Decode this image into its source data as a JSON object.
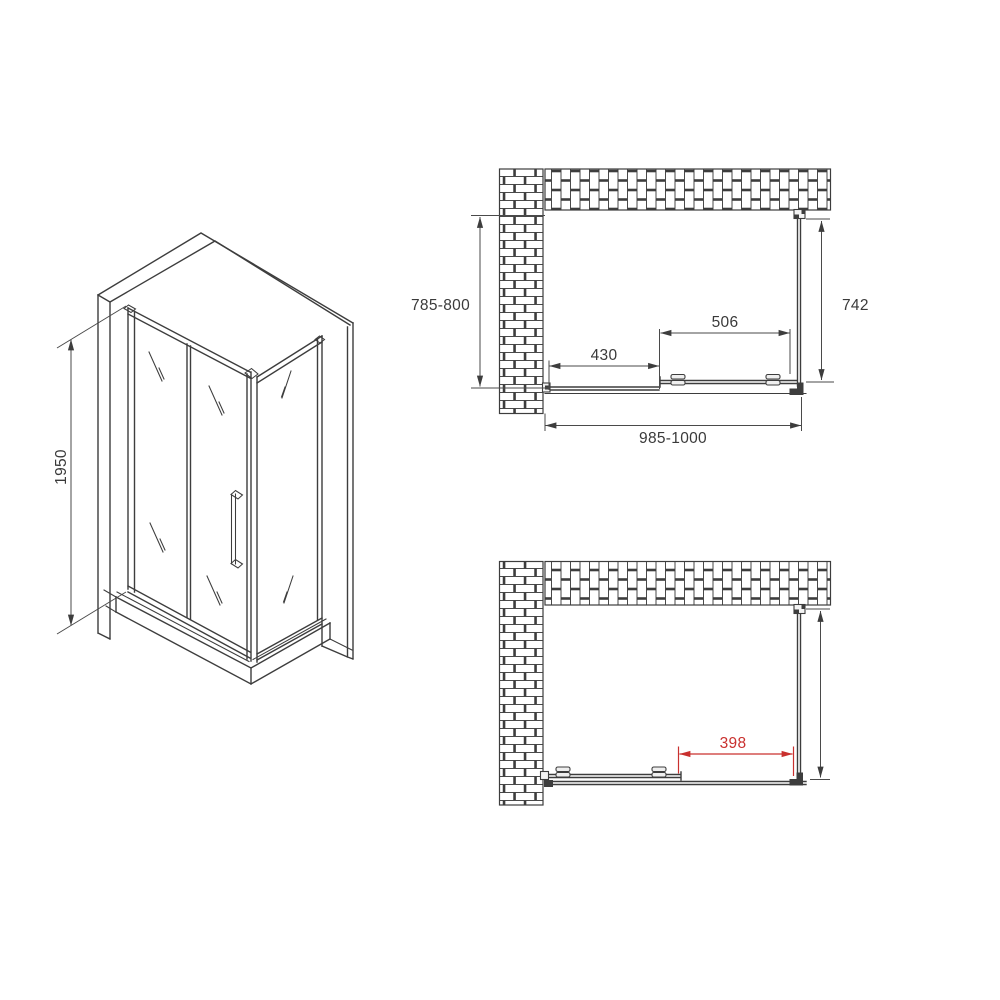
{
  "drawing_title": "Shower enclosure technical drawing (three views)",
  "colors": {
    "background": "#ffffff",
    "line": "#3d3d3d",
    "dimension": "#4a4a4a",
    "text": "#3a3a3a",
    "accent_red": "#c9302e"
  },
  "isometric_view": {
    "height": "1950"
  },
  "top_view": {
    "depth_range": "785-800",
    "side_panel_depth": "742",
    "door_panel_width": "506",
    "fixed_panel_width": "430",
    "width_range": "985-1000"
  },
  "bottom_view": {
    "door_opening": "398"
  }
}
